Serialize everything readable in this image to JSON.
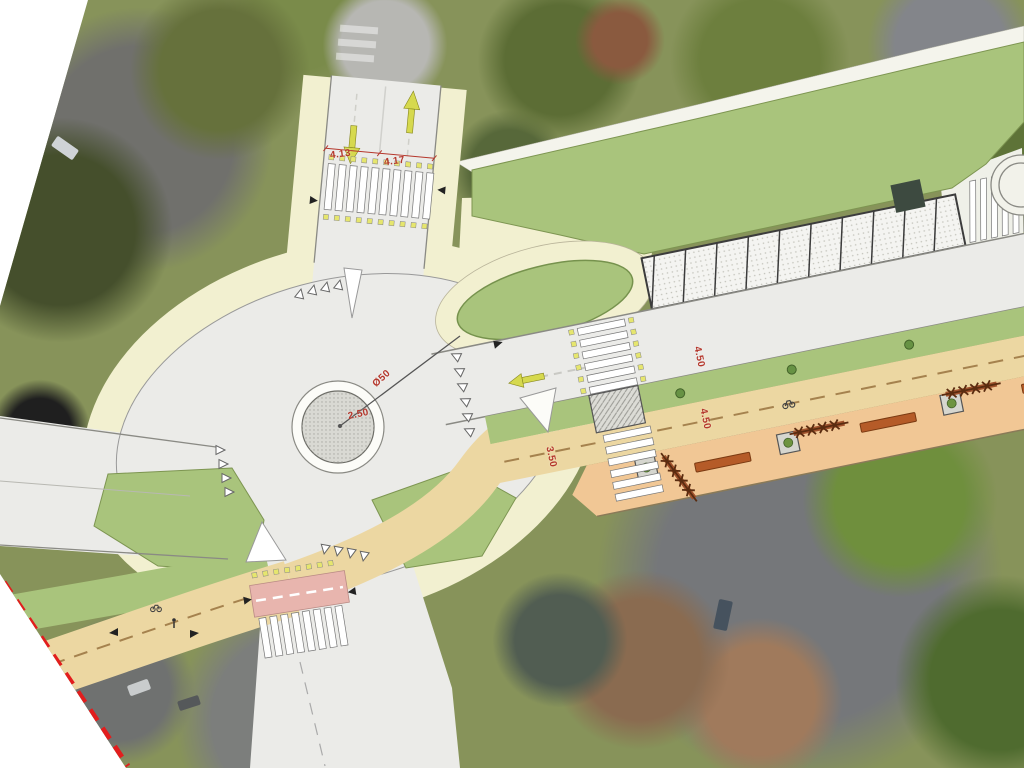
{
  "plan": {
    "dimensions": {
      "north_lane_left": "4.13",
      "north_lane_right": "4.17",
      "roundabout_diameter": "Ø50",
      "central_island_radius": "2.50",
      "carriageway_width": "4.50",
      "promenade_width": "4.50",
      "cycle_path_width": "3.50"
    },
    "parking_stall_count": 9,
    "colors": {
      "carriageway": "#ebebe8",
      "sidewalk_cream": "#f2f0d0",
      "plan_green": "#a9c47c",
      "cycle_path_beige": "#ecd7a2",
      "promenade_orange": "#f1c795",
      "cycle_crossing_pink": "#e8b5ae",
      "dimension_text_red": "#b5372c",
      "boundary_red": "#e21d1d",
      "lane_arrow_yellow": "#d6d94e"
    },
    "icons": [
      "lane-arrow-down-icon",
      "lane-arrow-up-icon",
      "lane-arrow-left-icon",
      "yield-triangle-icon",
      "zebra-crossing",
      "refuge-island",
      "bench-icon",
      "tree-planter-icon",
      "tree-row-icon",
      "street-tree-icon",
      "cyclist-icon",
      "pedestrian-icon",
      "direction-arrow-icon",
      "boundary-dashed-line"
    ]
  }
}
